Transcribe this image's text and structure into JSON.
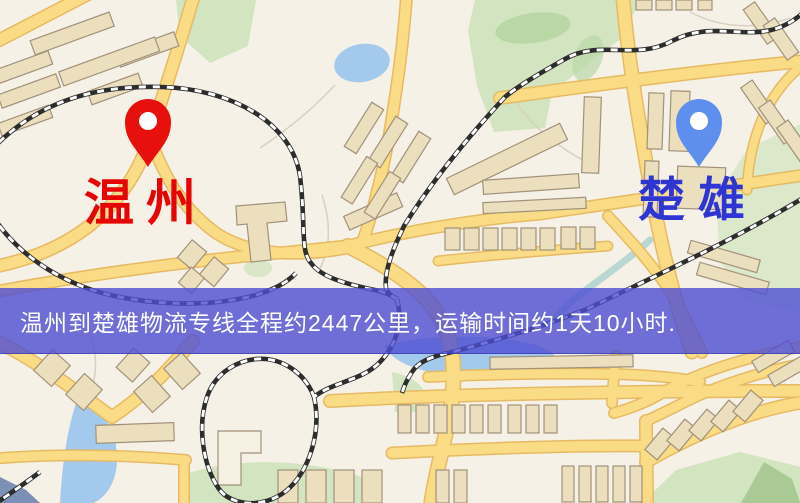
{
  "banner": {
    "text": "温州到楚雄物流专线全程约2447公里，运输时间约1天10小时.",
    "background_color": "#4d4ed3",
    "text_color": "#ffffff"
  },
  "markers": {
    "origin": {
      "label": "温州",
      "icon": "map-pin",
      "pin_color": "#e8100c",
      "label_color": "#e60404"
    },
    "destination": {
      "label": "楚雄",
      "icon": "map-pin",
      "pin_color": "#5f8fee",
      "label_color": "#2e35d1"
    }
  },
  "map": {
    "colors": {
      "background": "#f6f1e7",
      "road_fill": "#f9dc85",
      "road_casing": "#e6ba62",
      "building": "#ebdfbd",
      "green_area": "#d2e4c0",
      "water": "#a3c9ec",
      "railway_dark": "#2d2d2d",
      "railway_light": "#ffffff"
    }
  }
}
